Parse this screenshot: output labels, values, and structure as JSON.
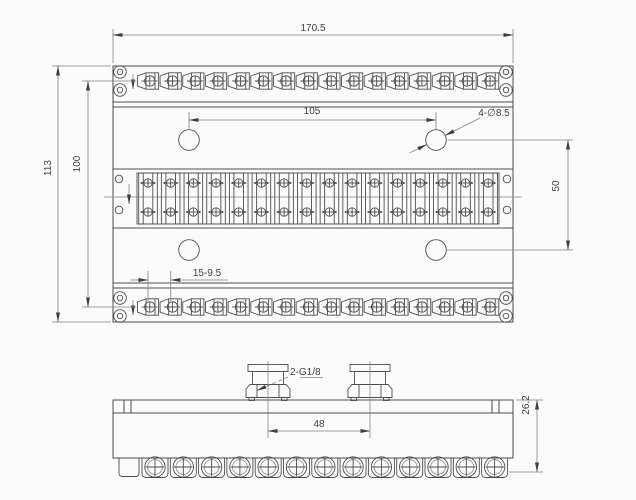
{
  "drawing": {
    "views": {
      "top_view": {
        "dim_overall_width": "170.5",
        "dim_overall_height": "113",
        "dim_fitting_row_spacing": "100",
        "dim_hole_spacing_horizontal": "105",
        "dim_hole_spacing_vertical": "50",
        "callout_mounting_holes": "4-∅8.5",
        "dim_fitting_pitch": "15-9.5"
      },
      "front_view": {
        "callout_ports_prefix": "2-",
        "callout_ports_thread": "G1/8",
        "dim_port_spacing": "48",
        "dim_height": "26.2"
      }
    },
    "counts": {
      "fittings_per_row": 16,
      "fitting_rows": 2,
      "terminal_columns": 16,
      "screws_per_column": 2,
      "mounting_holes": 4,
      "corner_hole_pairs": 4,
      "ports": 2,
      "bottom_screws": 13
    },
    "colors": {
      "line": "#4d4d4d",
      "thin_line": "#808080",
      "text": "#3f3f3f",
      "background": "#fbfbfb"
    }
  }
}
